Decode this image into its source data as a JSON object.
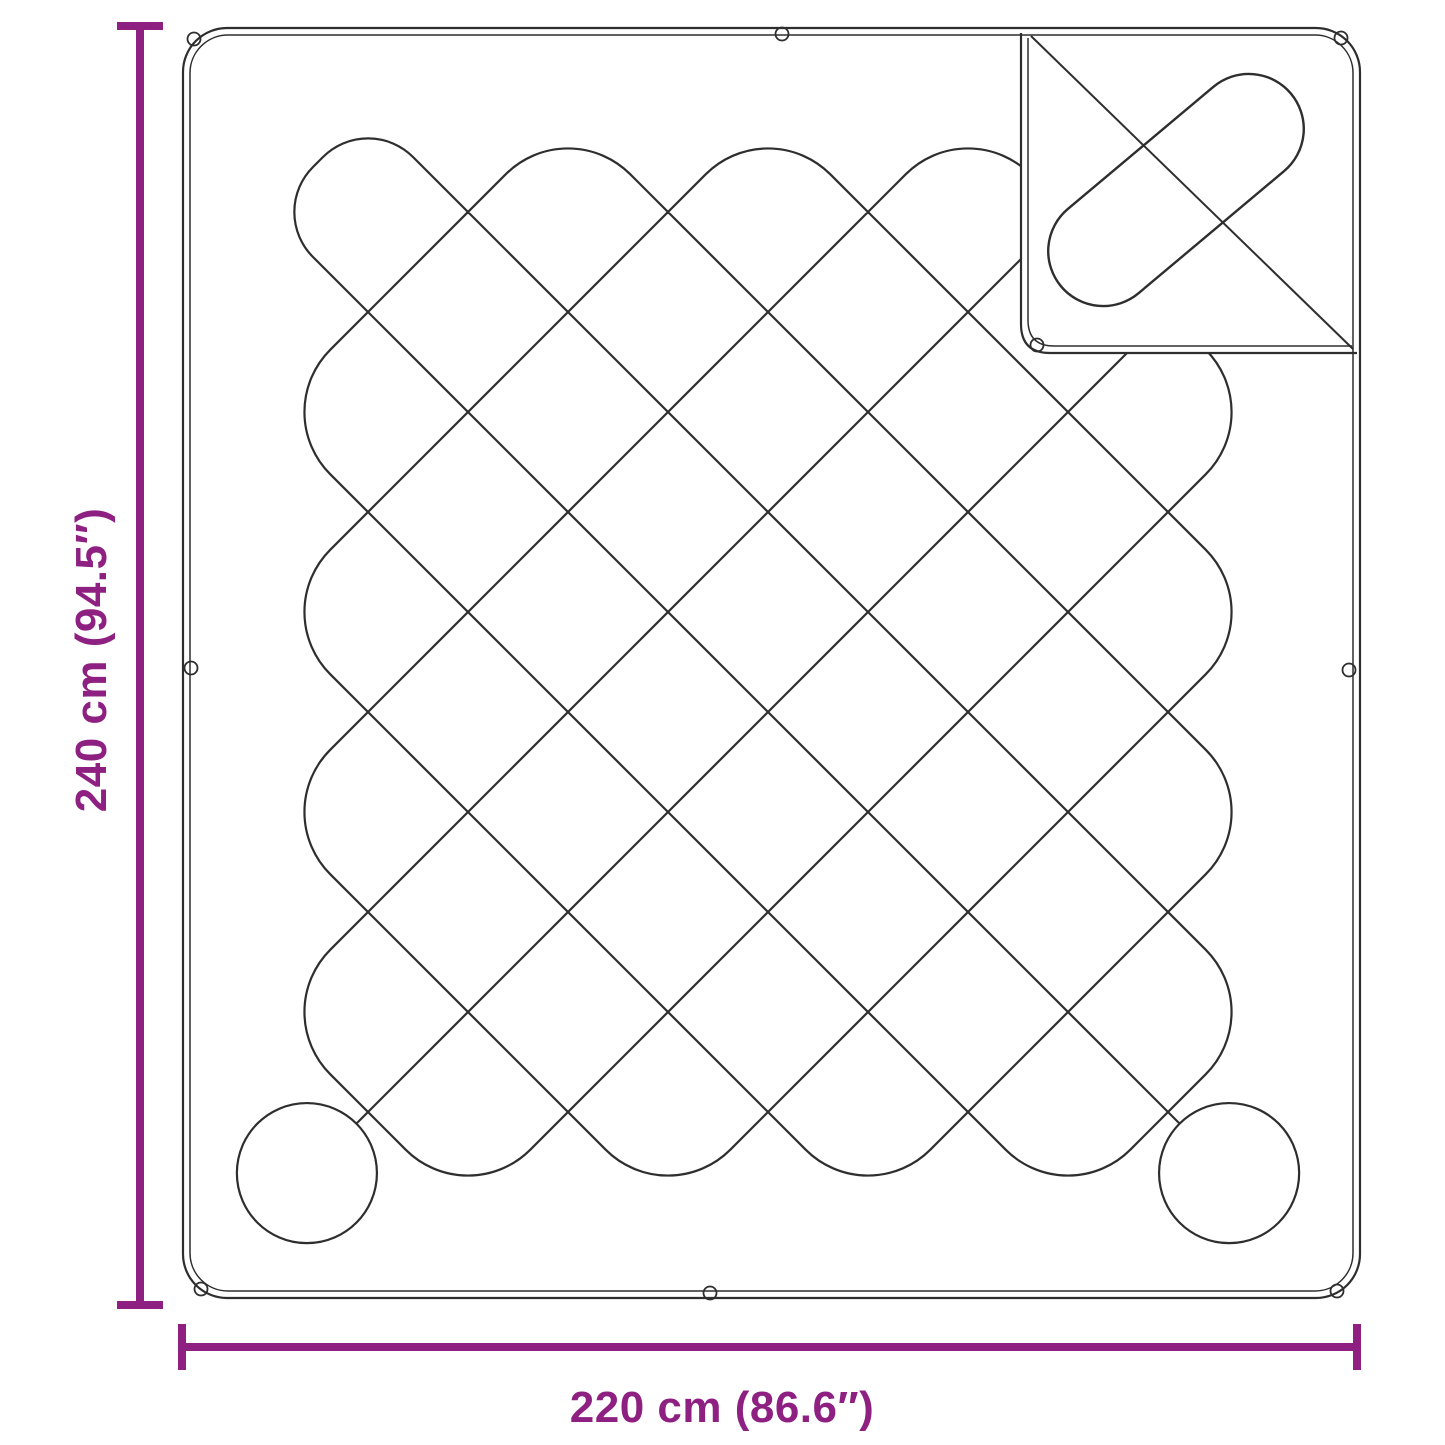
{
  "diagram": {
    "dimensions": {
      "height": {
        "label": "240 cm (94.5″)"
      },
      "width": {
        "label": "220 cm (86.6″)"
      }
    },
    "colors": {
      "dimension_accent": "#8E2082",
      "outline": "#2e2e2e",
      "background": "#ffffff"
    }
  }
}
